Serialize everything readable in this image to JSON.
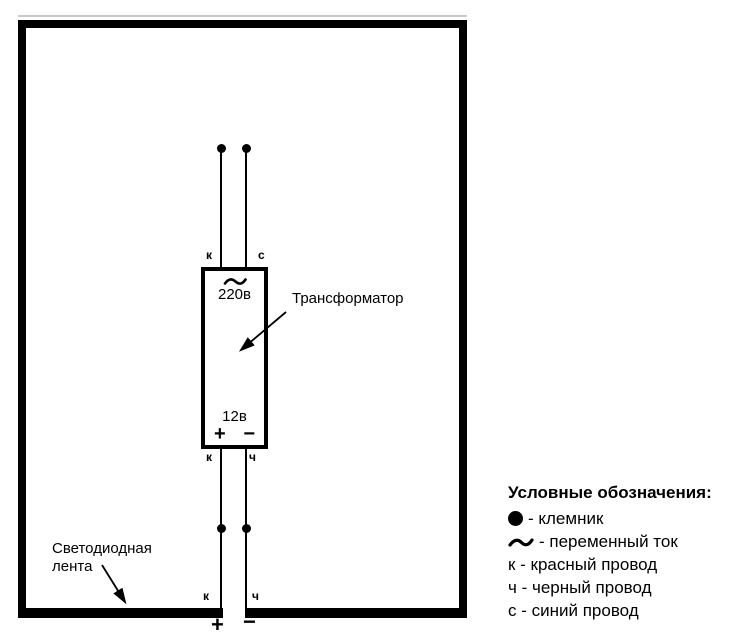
{
  "colors": {
    "ink": "#000000",
    "background": "#ffffff"
  },
  "transformer": {
    "name": "Трансформатор",
    "primary_voltage": "220в",
    "secondary_voltage": "12в",
    "plus": "+",
    "minus": "−"
  },
  "wire_labels": {
    "top_left": "к",
    "top_right": "с",
    "mid_left": "к",
    "mid_right": "ч",
    "bottom_left": "к",
    "bottom_right": "ч"
  },
  "output_terminals": {
    "plus": "+",
    "minus": "−"
  },
  "led_strip": {
    "label_line1": "Светодиодная",
    "label_line2": "лента"
  },
  "legend": {
    "title": "Условные обозначения:",
    "items": [
      {
        "symbol": "terminal-dot",
        "text": "- клемник"
      },
      {
        "symbol": "ac-tilde",
        "text": "- переменный ток"
      },
      {
        "symbol": "letter-k",
        "text": "к - красный провод"
      },
      {
        "symbol": "letter-ch",
        "text": "ч - черный провод"
      },
      {
        "symbol": "letter-s",
        "text": "с - синий провод"
      }
    ]
  }
}
